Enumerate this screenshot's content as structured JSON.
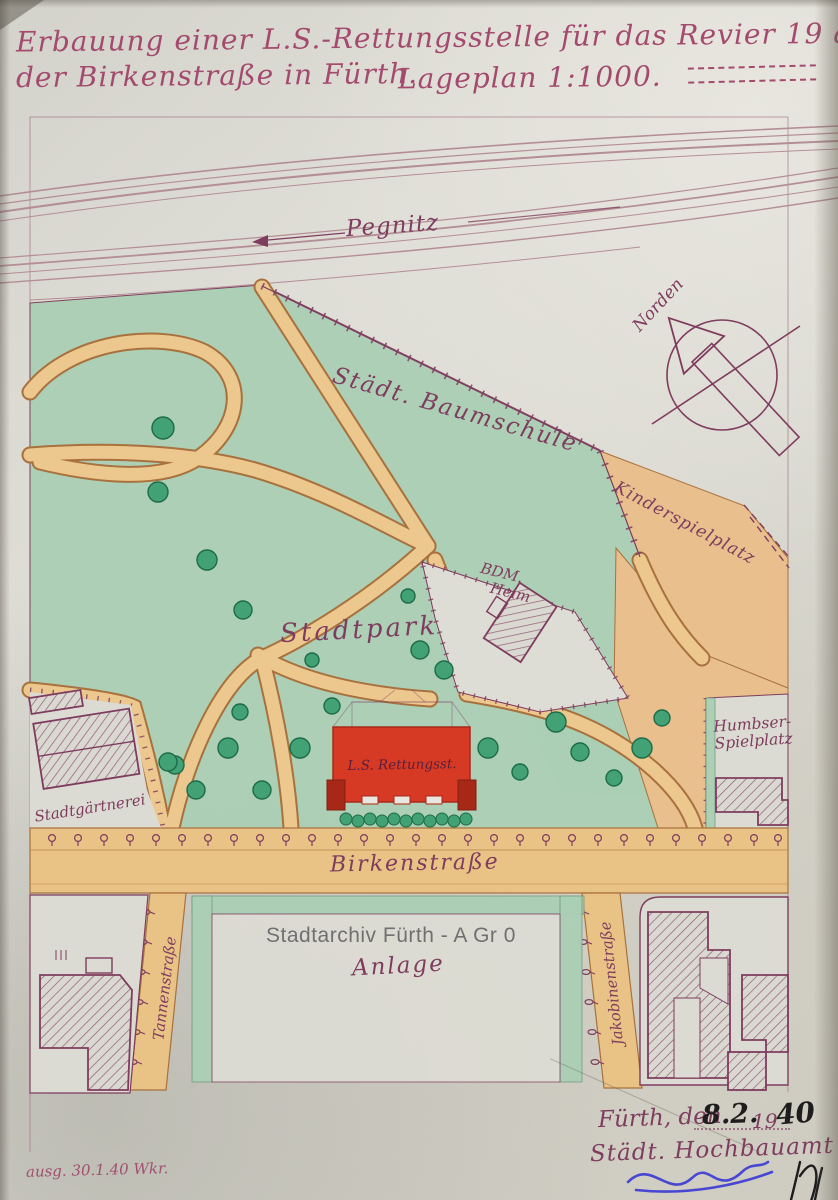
{
  "document": {
    "title_line1": "Erbauung einer L.S.-Rettungsstelle für das Revier 19 an",
    "title_line2": "der Birkenstraße in Fürth.",
    "title_scale": "Lageplan 1:1000.",
    "watermark": "Stadtarchiv Fürth - A Gr 0",
    "footer_note": "ausg. 30.1.40 Wkr.",
    "date_place": "Fürth, den",
    "date_day_month": "8.2.",
    "date_year_prefix": "19",
    "date_year_suffix": "40",
    "office": "Städt. Hochbauamt"
  },
  "map": {
    "river_label": "Pegnitz",
    "compass_label": "Norden",
    "areas": {
      "baumschule": "Städt. Baumschule",
      "kinderspielplatz": "Kinderspielplatz",
      "stadtpark": "Stadtpark",
      "stadtgaertnerei": "Stadtgärtnerei",
      "humbser_line1": "Humbser-",
      "humbser_line2": "Spielplatz",
      "anlage": "Anlage",
      "heim_line1": "BDM.",
      "heim_line2": "Heim"
    },
    "buildings": {
      "rettungsstelle": "L.S. Rettungsst."
    },
    "streets": {
      "birkenstrasse": "Birkenstraße",
      "tannenstrasse": "Tannenstraße",
      "jakobinenstrasse": "Jakobinenstraße"
    },
    "colors": {
      "ink": "#7e3c5e",
      "title_ink": "#a34a6e",
      "park_green": "#abcfb5",
      "tree_green": "#43a176",
      "tree_edge": "#1e6b48",
      "path_tan": "#ecc88f",
      "path_edge": "#a8713d",
      "street_tan": "#e9c285",
      "play_tan": "#e8bf8d",
      "red": "#d63a24",
      "red_dark": "#a82818",
      "river": "#b48e96",
      "watermark": "#707070",
      "blue": "#4747d1",
      "black": "#1d1d1d"
    }
  }
}
